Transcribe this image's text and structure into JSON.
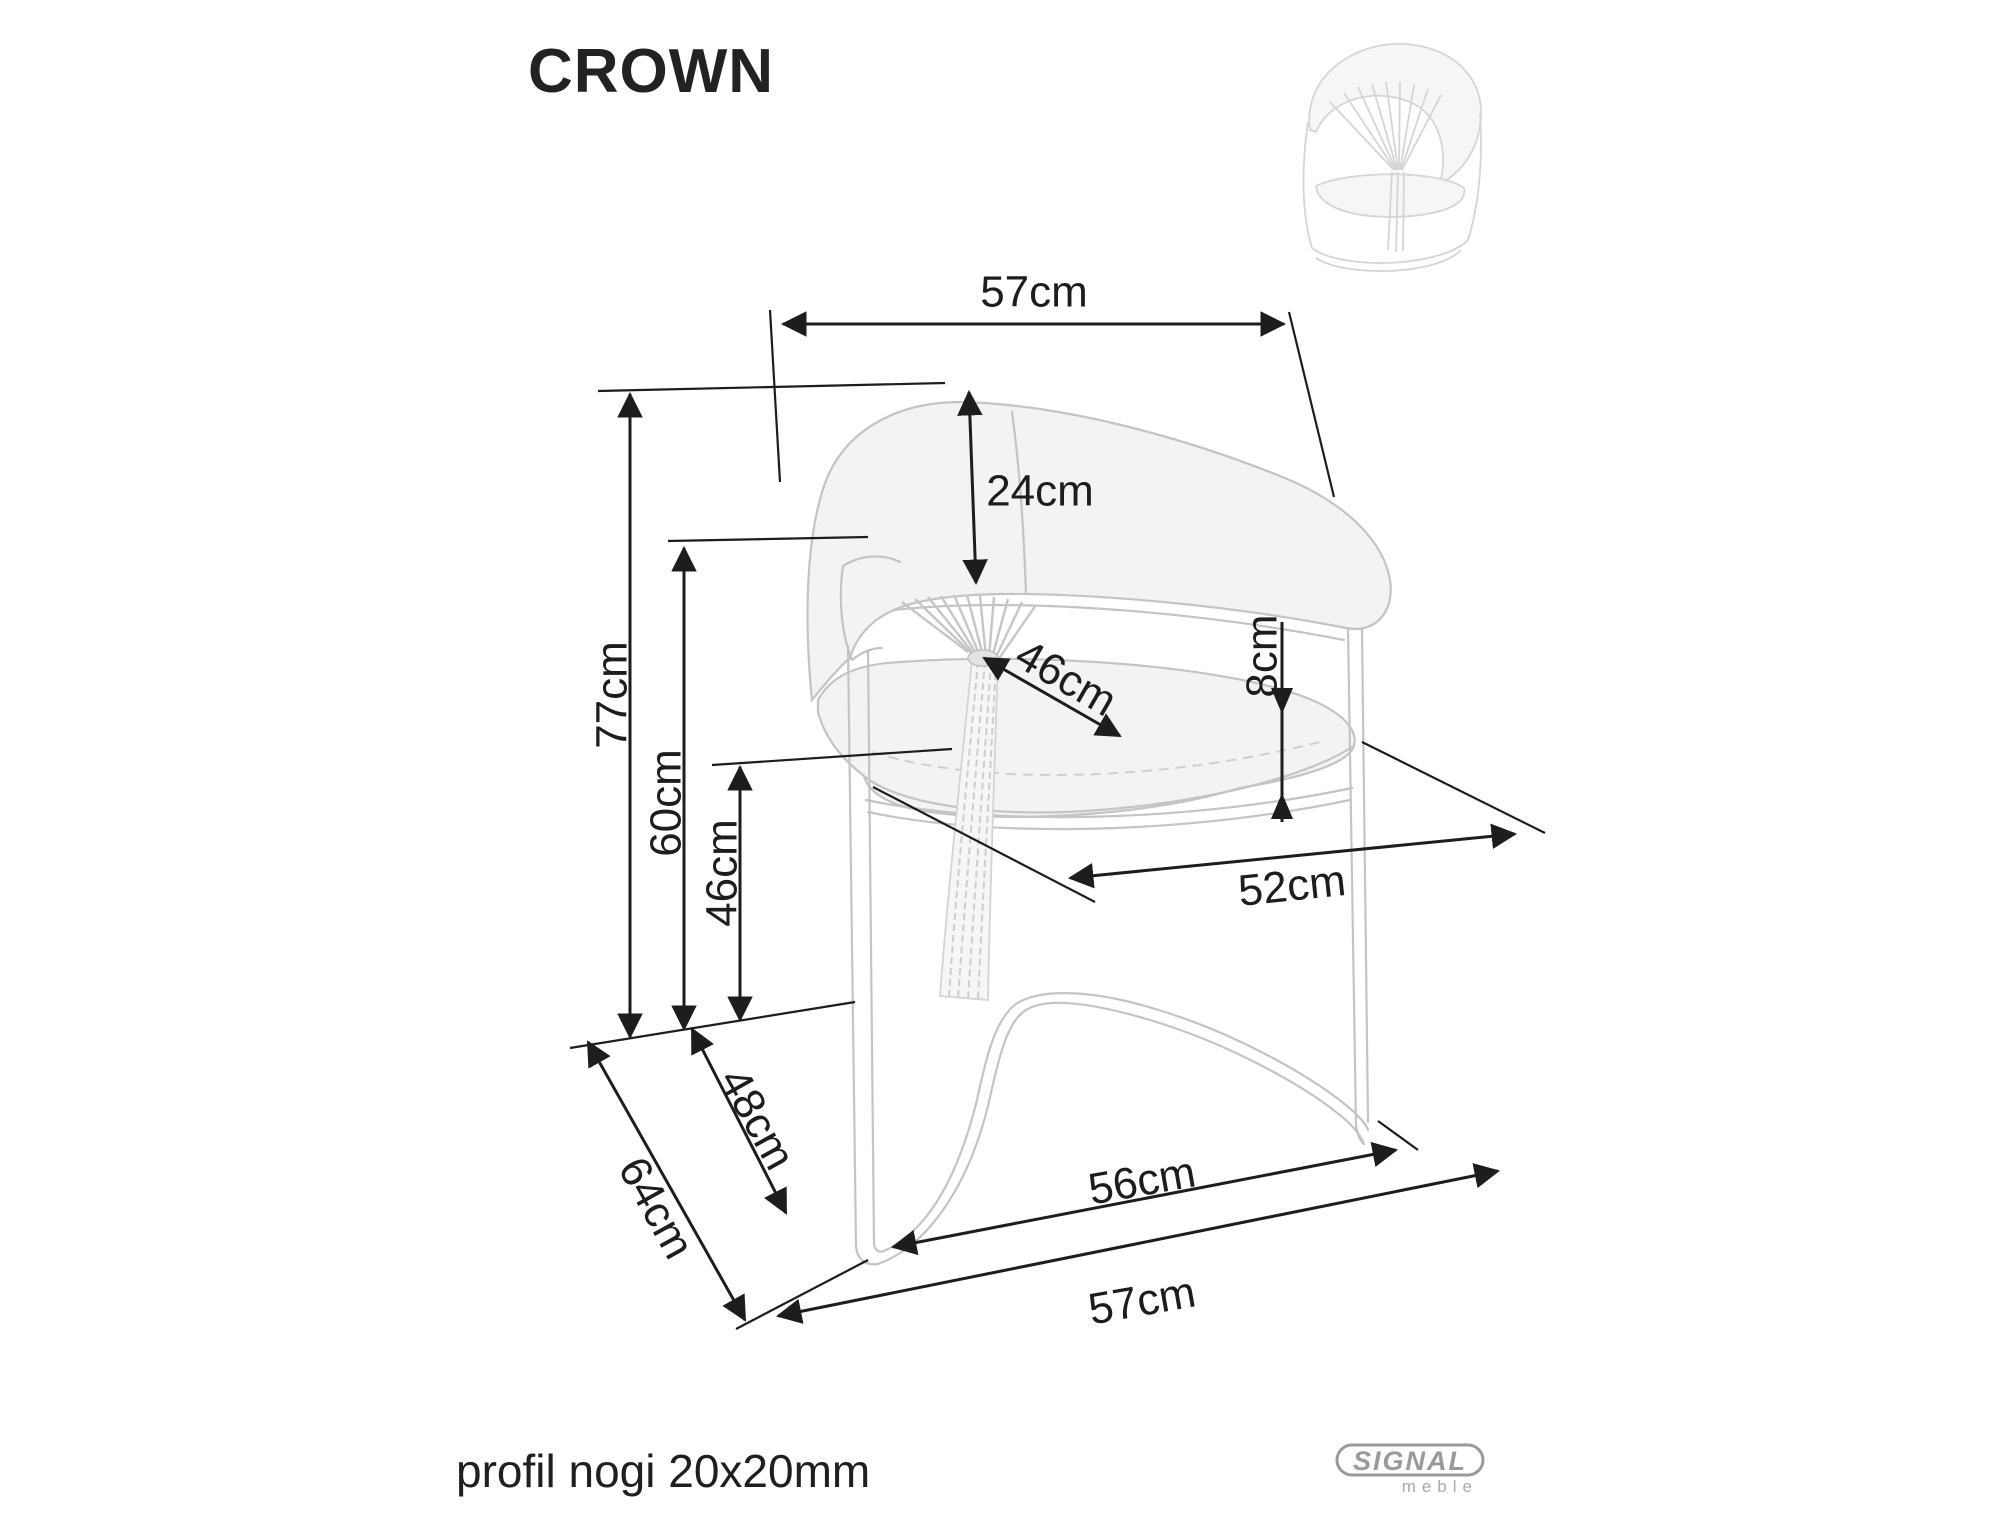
{
  "page": {
    "title": "CROWN",
    "footnote": "profil nogi 20x20mm"
  },
  "brand": {
    "name": "SIGNAL",
    "sub": "meble"
  },
  "diagram": {
    "type": "furniture-dimension-drawing",
    "product": "CROWN chair",
    "dimensions": {
      "backrest_top_width": "57cm",
      "backrest_band_height": "24cm",
      "overall_height": "77cm",
      "armrest_height": "60cm",
      "seat_height": "46cm",
      "seat_inner_depth": "46cm",
      "cushion_thickness": "8cm",
      "seat_width": "52cm",
      "base_side_depth": "48cm",
      "overall_depth": "64cm",
      "base_front_width": "56cm",
      "overall_width": "57cm"
    },
    "colors": {
      "line": "#1d1d1d",
      "chair_stroke": "#c4c4c4",
      "chair_fill": "#f3f3f3",
      "brand_gray": "#9a9a9a"
    }
  }
}
